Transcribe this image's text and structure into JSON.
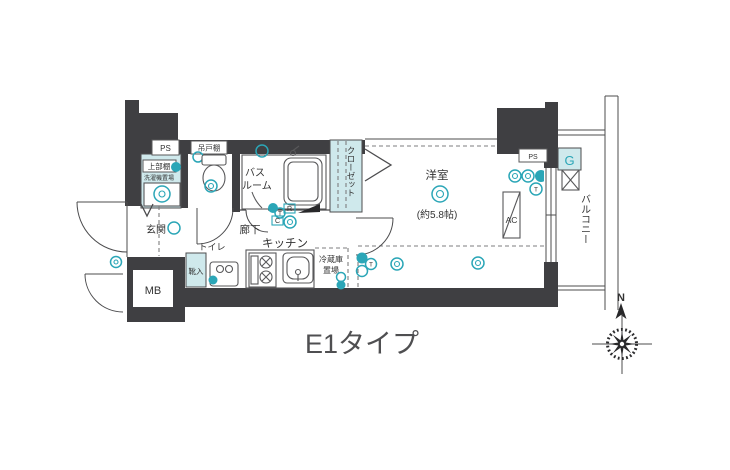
{
  "floorplan": {
    "caption": "E1タイプ",
    "compass_north": "N",
    "rooms": {
      "entrance": "玄関",
      "hallway": "廊下",
      "kitchen": "キッチン",
      "toilet": "トイレ",
      "bath_line1": "バス",
      "bath_line2": "ルーム",
      "closet": "クローゼット",
      "western_room": "洋室",
      "western_room_size": "(約5.8帖)",
      "balcony": "バルコニー"
    },
    "fixtures": {
      "ps_left": "PS",
      "ps_right": "PS",
      "meter_box": "MB",
      "upper_shelf": "上部棚",
      "laundry_space": "洗濯機置場",
      "hanging_cupboard": "吊戸棚",
      "shoe_cabinet": "靴入",
      "fridge_line1": "冷蔵庫",
      "fridge_line2": "置場",
      "air_con": "AC",
      "gas": "G"
    },
    "switch_letters": {
      "r": "R",
      "c": "C",
      "t": "T"
    },
    "colors": {
      "wall": "#3f3f42",
      "teal_fill": "#cfe9ec",
      "teal_stroke": "#2ba6b7",
      "line": "#4c4c4e",
      "text": "#333333",
      "caption": "#4f4f51"
    }
  }
}
